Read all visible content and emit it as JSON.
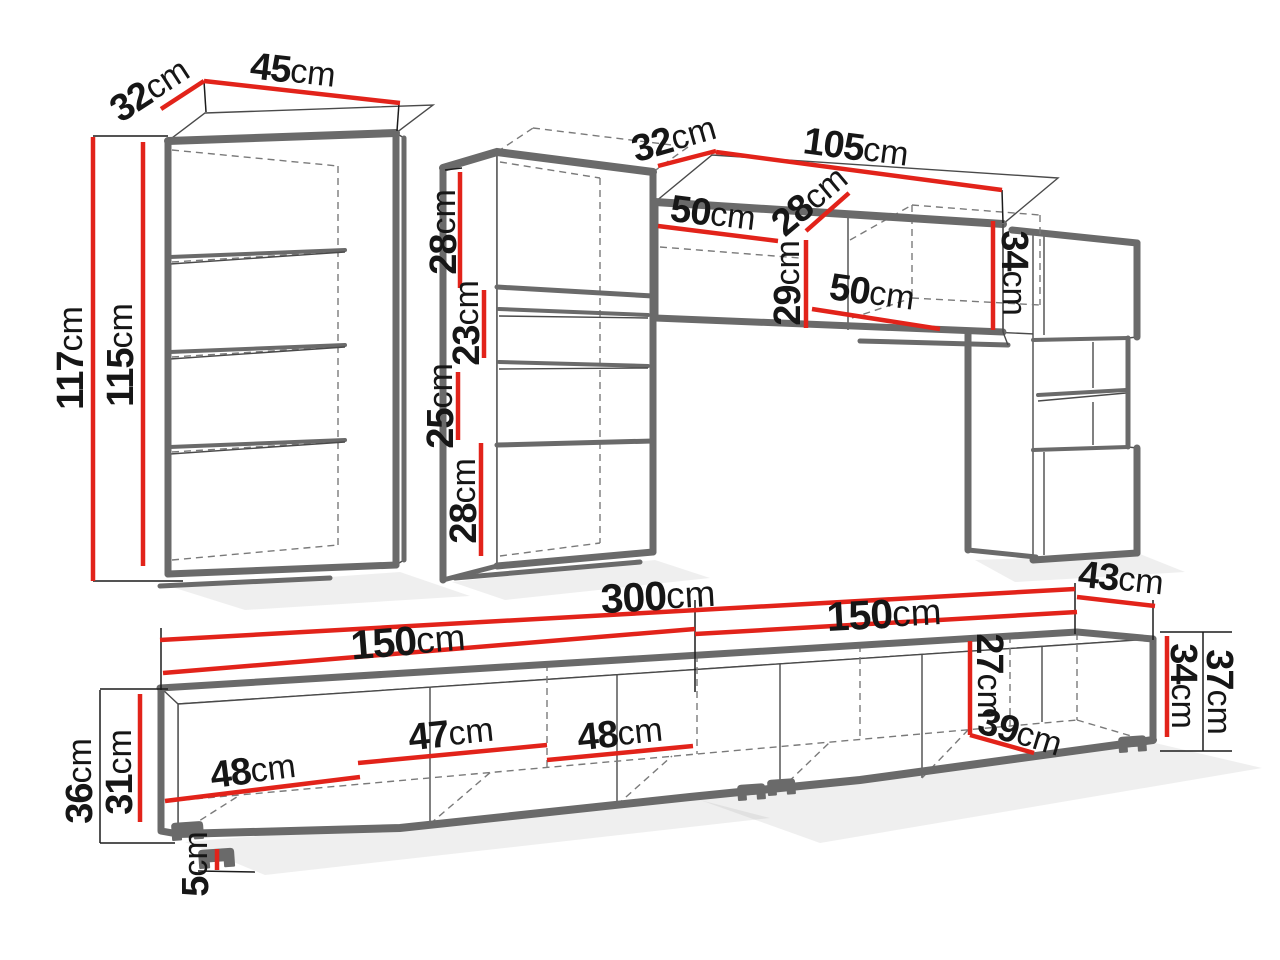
{
  "diagram": {
    "kind": "furniture-dimension-diagram",
    "units": "cm",
    "colors": {
      "dimension_line_red": "#e2231a",
      "outline_gray": "#6a6a6a",
      "extension_line_black": "#1c1c1c",
      "background": "#ffffff",
      "label_text": "#161616"
    }
  },
  "dims": {
    "left_cabinet": {
      "depth": {
        "v": "32",
        "u": "cm"
      },
      "width": {
        "v": "45",
        "u": "cm"
      },
      "height_outer": {
        "v": "117",
        "u": "cm"
      },
      "height_inner": {
        "v": "115",
        "u": "cm"
      }
    },
    "middle_column": {
      "section_1": {
        "v": "28",
        "u": "cm"
      },
      "section_2": {
        "v": "23",
        "u": "cm"
      },
      "section_3": {
        "v": "25",
        "u": "cm"
      },
      "section_4": {
        "v": "28",
        "u": "cm"
      }
    },
    "wall_cabinet": {
      "depth": {
        "v": "32",
        "u": "cm"
      },
      "width": {
        "v": "105",
        "u": "cm"
      },
      "inner_left": {
        "v": "50",
        "u": "cm"
      },
      "inner_depth": {
        "v": "28",
        "u": "cm"
      },
      "inner_height": {
        "v": "29",
        "u": "cm"
      },
      "inner_right": {
        "v": "50",
        "u": "cm"
      },
      "height": {
        "v": "34",
        "u": "cm"
      }
    },
    "tv_stand": {
      "total_width": {
        "v": "300",
        "u": "cm"
      },
      "left_width": {
        "v": "150",
        "u": "cm"
      },
      "right_width": {
        "v": "150",
        "u": "cm"
      },
      "depth": {
        "v": "43",
        "u": "cm"
      },
      "compartment_1": {
        "v": "48",
        "u": "cm"
      },
      "compartment_2": {
        "v": "47",
        "u": "cm"
      },
      "compartment_3": {
        "v": "48",
        "u": "cm"
      },
      "height_outer": {
        "v": "36",
        "u": "cm"
      },
      "height_inner": {
        "v": "31",
        "u": "cm"
      },
      "leg_height": {
        "v": "5",
        "u": "cm"
      },
      "inner_height_right": {
        "v": "27",
        "u": "cm"
      },
      "inner_depth_right": {
        "v": "39",
        "u": "cm"
      },
      "body_height_right": {
        "v": "34",
        "u": "cm"
      },
      "total_height_right": {
        "v": "37",
        "u": "cm"
      }
    }
  }
}
